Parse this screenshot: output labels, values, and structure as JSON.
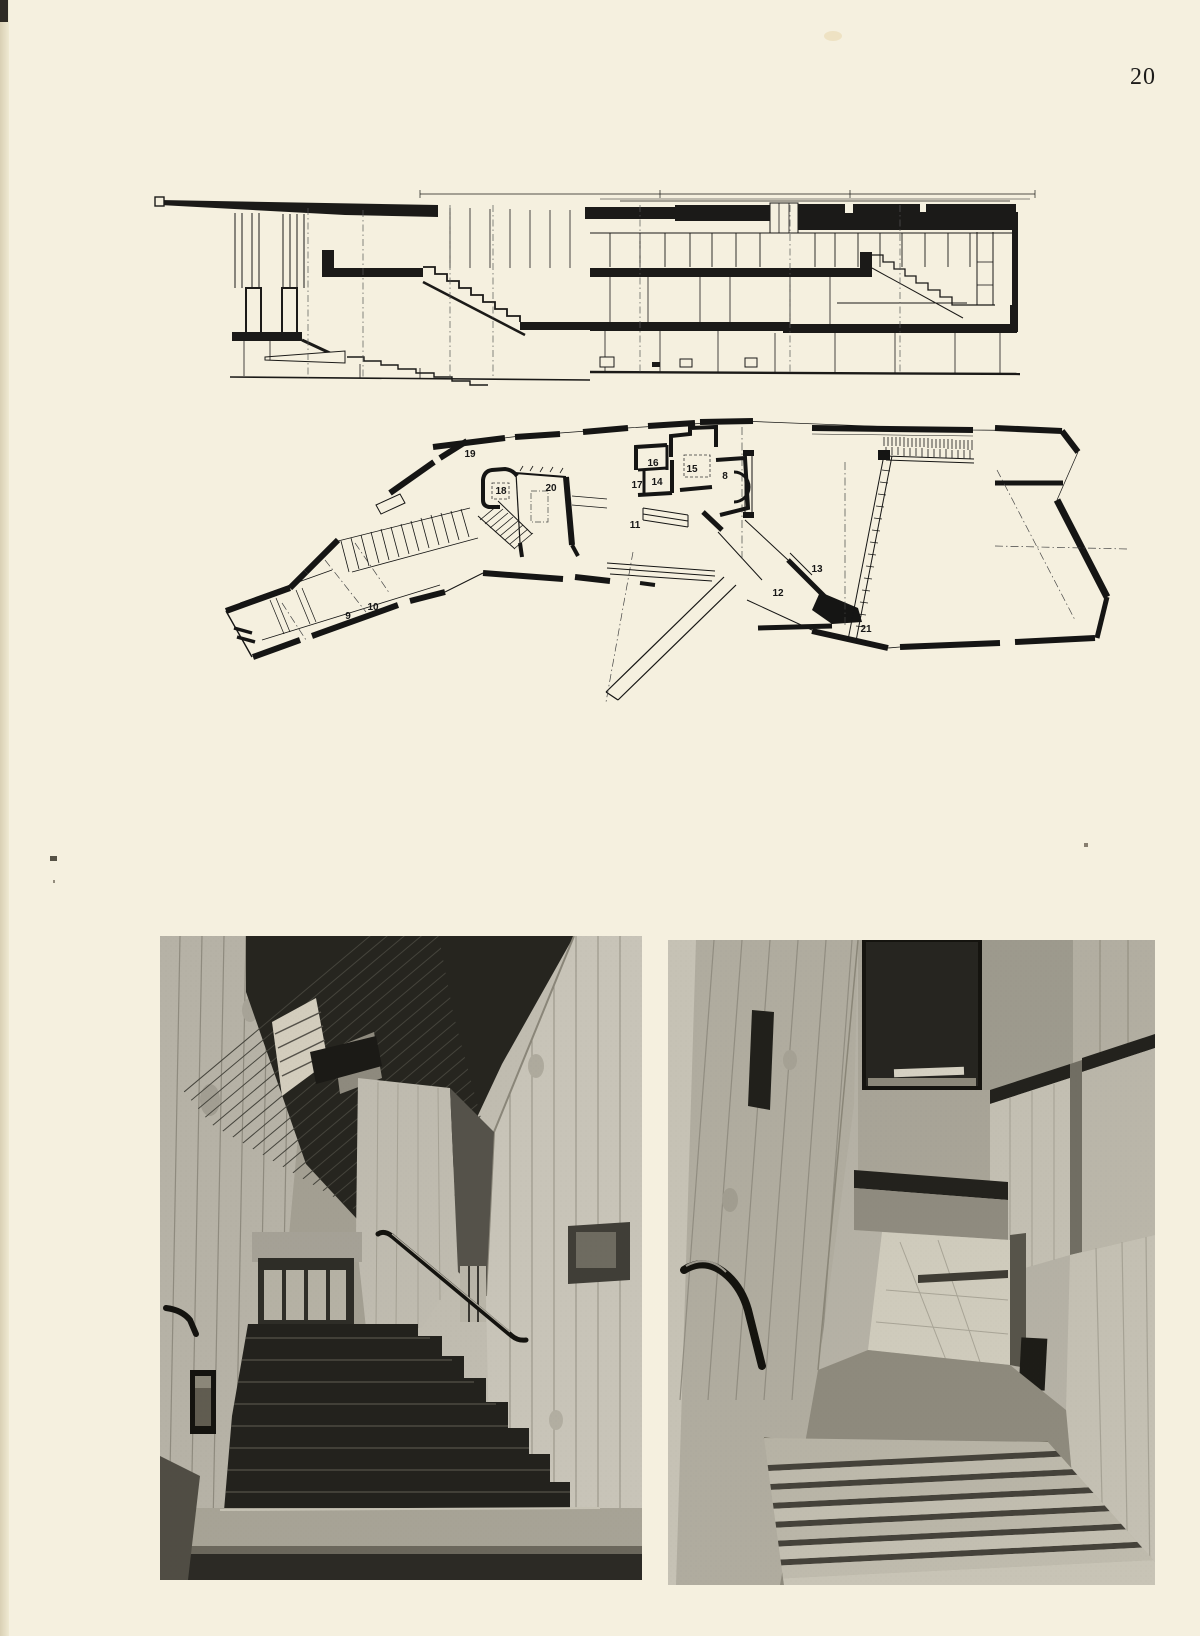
{
  "page": {
    "number": "20",
    "colors": {
      "paper": "#f5f0df",
      "ink": "#1b1a18"
    }
  },
  "floor_plan": {
    "room_labels": [
      {
        "id": "19",
        "x": 470,
        "y": 457
      },
      {
        "id": "18",
        "x": 501,
        "y": 494
      },
      {
        "id": "20",
        "x": 551,
        "y": 491
      },
      {
        "id": "16",
        "x": 653,
        "y": 466
      },
      {
        "id": "15",
        "x": 692,
        "y": 472
      },
      {
        "id": "17",
        "x": 637,
        "y": 488
      },
      {
        "id": "14",
        "x": 657,
        "y": 485
      },
      {
        "id": "8",
        "x": 725,
        "y": 479
      },
      {
        "id": "11",
        "x": 635,
        "y": 528
      },
      {
        "id": "13",
        "x": 817,
        "y": 572
      },
      {
        "id": "12",
        "x": 778,
        "y": 596
      },
      {
        "id": "21",
        "x": 866,
        "y": 632
      },
      {
        "id": "9",
        "x": 348,
        "y": 619
      },
      {
        "id": "10",
        "x": 373,
        "y": 610
      }
    ]
  }
}
